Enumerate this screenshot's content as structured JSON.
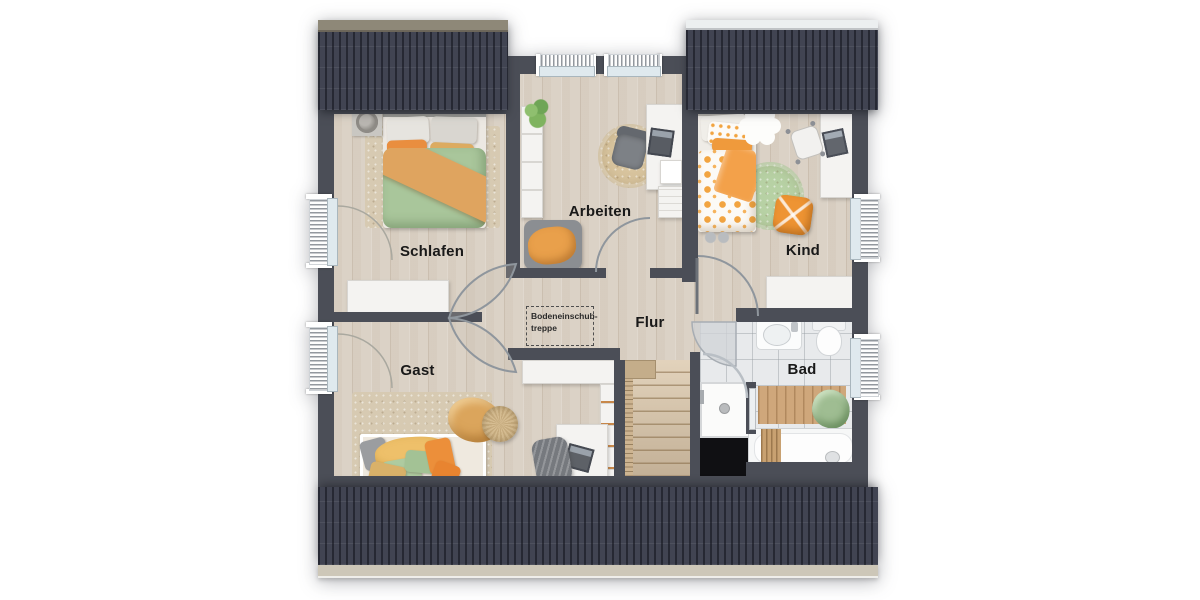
{
  "plan": {
    "type": "floorplan-top-view",
    "floor": "upper floor with dormers"
  },
  "rooms": {
    "schlafen": {
      "label": "Schlafen"
    },
    "arbeiten": {
      "label": "Arbeiten"
    },
    "kind": {
      "label": "Kind"
    },
    "gast": {
      "label": "Gast"
    },
    "flur": {
      "label": "Flur"
    },
    "bad": {
      "label": "Bad"
    }
  },
  "annotations": {
    "attic_ladder": {
      "line1": "Bodeneinschub-",
      "line2": "treppe"
    }
  },
  "colors": {
    "roof": "#414452",
    "wall": "#4b4e57",
    "floor": "#dbd2c6",
    "tile": "#e8eaec",
    "void": "#101013",
    "accent_orange": "#ec9a40",
    "accent_green": "#aecba0",
    "rug_beige": "#d7cab2",
    "stair_wood": "#dcc9ad"
  }
}
